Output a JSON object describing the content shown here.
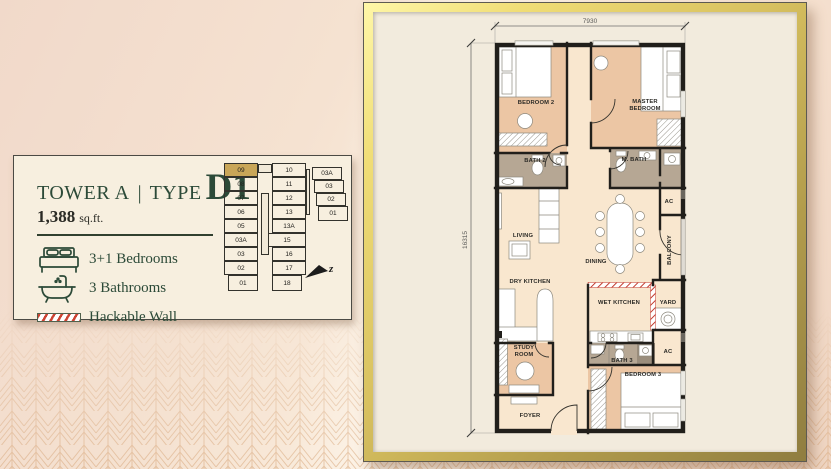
{
  "colors": {
    "green": "#2c4a38",
    "gold": "#c9a658",
    "tan": "#ecc6a4",
    "bathgray": "#b6a794",
    "cream": "#f9e7cf",
    "wall": "#211f1b",
    "hackred": "#c23b2e",
    "framecream": "#f2ebdd"
  },
  "card": {
    "title": {
      "tower": "TOWER A",
      "separator": "|",
      "type_word": "TYPE",
      "type_code": "D1"
    },
    "area": {
      "value": "1,388",
      "unit": "sq.ft."
    },
    "features": [
      {
        "icon": "bed-icon",
        "label": "3+1 Bedrooms"
      },
      {
        "icon": "bathtub-icon",
        "label": "3 Bathrooms"
      },
      {
        "icon": "hackable-wall-icon",
        "label": "Hackable Wall"
      }
    ],
    "keyplan": {
      "highlight_unit": "09",
      "left_column": [
        "09",
        "08",
        "07",
        "06",
        "05",
        "03A",
        "03",
        "02",
        "01"
      ],
      "right_column": [
        "10",
        "11",
        "12",
        "13",
        "13A",
        "15",
        "16",
        "17",
        "18"
      ],
      "annex_column": [
        "03A",
        "03",
        "02",
        "01"
      ],
      "north_label": "z"
    }
  },
  "plan": {
    "dim_width": "7930",
    "dim_height": "16315",
    "rooms": {
      "bedroom2": "BEDROOM 2",
      "master_line1": "MASTER",
      "master_line2": "BEDROOM",
      "bath2": "BATH 2",
      "mbath": "M. BATH",
      "ac_top": "AC",
      "living": "LIVING",
      "dining": "DINING",
      "balcony": "BALCONY",
      "dry_kitchen": "DRY KITCHEN",
      "wet_kitchen": "WET KITCHEN",
      "yard": "YARD",
      "study_line1": "STUDY",
      "study_line2": "ROOM",
      "bath3": "BATH 3",
      "ac_bottom": "AC",
      "bedroom3": "BEDROOM 3",
      "foyer": "FOYER"
    }
  }
}
